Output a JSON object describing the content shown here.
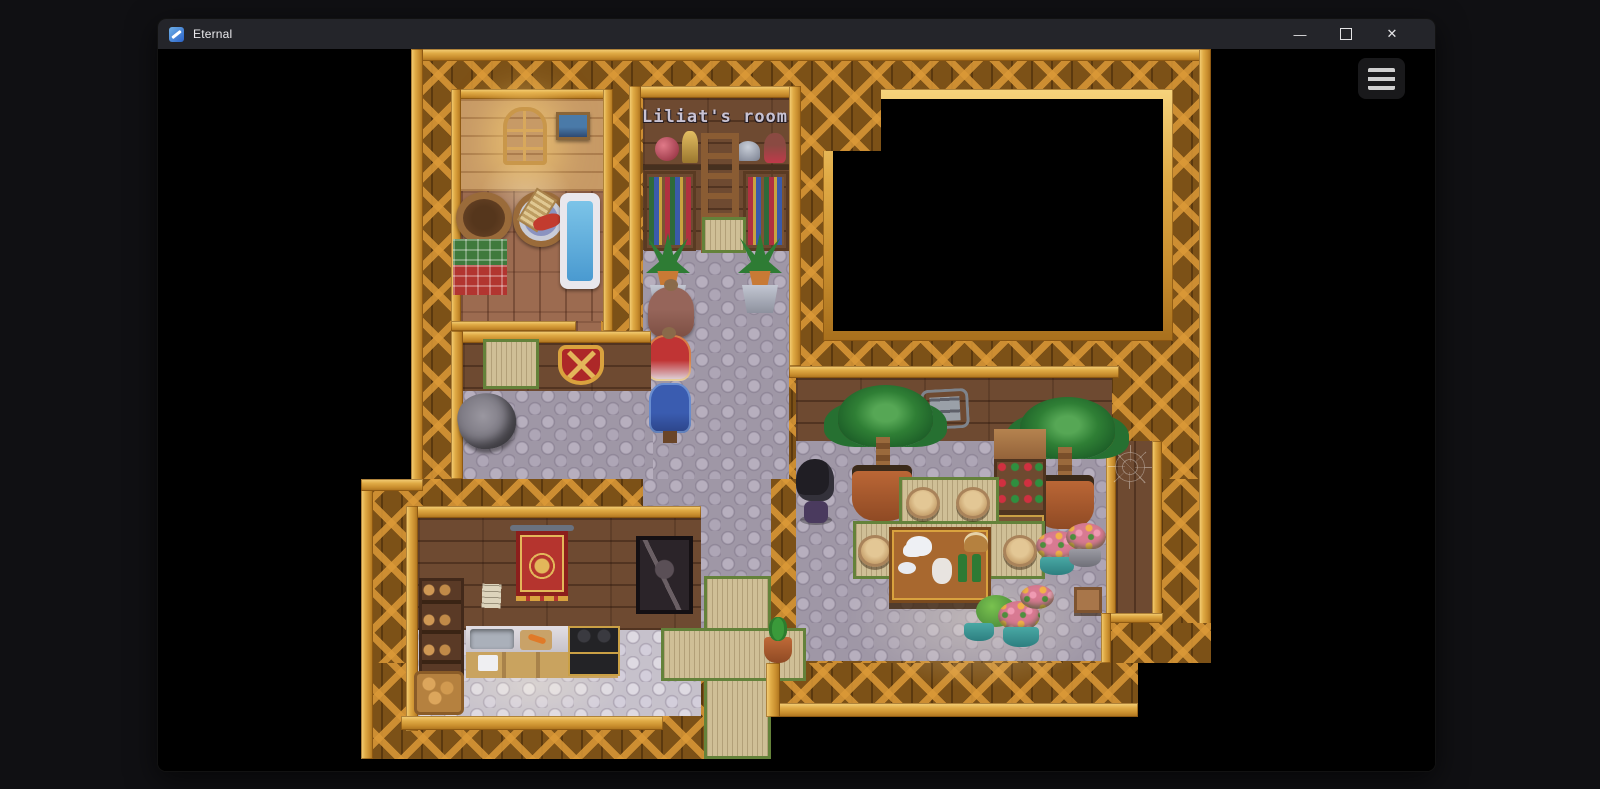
{
  "window": {
    "title": "Eternal",
    "app_icon": "app-icon",
    "controls": {
      "minimize_glyph": "—",
      "maximize_glyph": "maximize-box",
      "close_glyph": "✕"
    }
  },
  "game": {
    "menu_button_icon": "hamburger-menu-icon",
    "map_label": "Liliat's room",
    "colors": {
      "title_bar": "#24252a",
      "gold_frame": "#d9a23e",
      "lattice_wall": "#7c5117",
      "dark_wood_wall": "#6e4a31",
      "stone_floor": "#9f97a6",
      "tatami_floor": "#cfbf96",
      "bathtub_water": "#5ab4e0",
      "window_glow": "#ffe9b0"
    },
    "scene_objects": [
      "bathhouse-window",
      "landscape-painting",
      "wooden-tub",
      "wash-basin",
      "bathtub",
      "green-towel",
      "red-towel",
      "bookshelf",
      "ladder",
      "crystal-orb",
      "gold-statue",
      "helmet",
      "doll",
      "potted-plant",
      "mannequin-brown-dress",
      "mannequin-red-outfit",
      "mannequin-blue-coat",
      "wall-shield",
      "broken-pot",
      "red-tapestry",
      "armor-picture",
      "wall-note",
      "bread-shelf",
      "kitchen-counter",
      "sink",
      "cutting-board",
      "stove",
      "bread-basket",
      "stone-sign",
      "palm-plant",
      "wine-rack",
      "round-stool",
      "dining-table",
      "teapot",
      "pitcher",
      "wine-bottles",
      "flower-pots",
      "spider-web",
      "cactus-pot",
      "player-character",
      "dark-room"
    ]
  }
}
